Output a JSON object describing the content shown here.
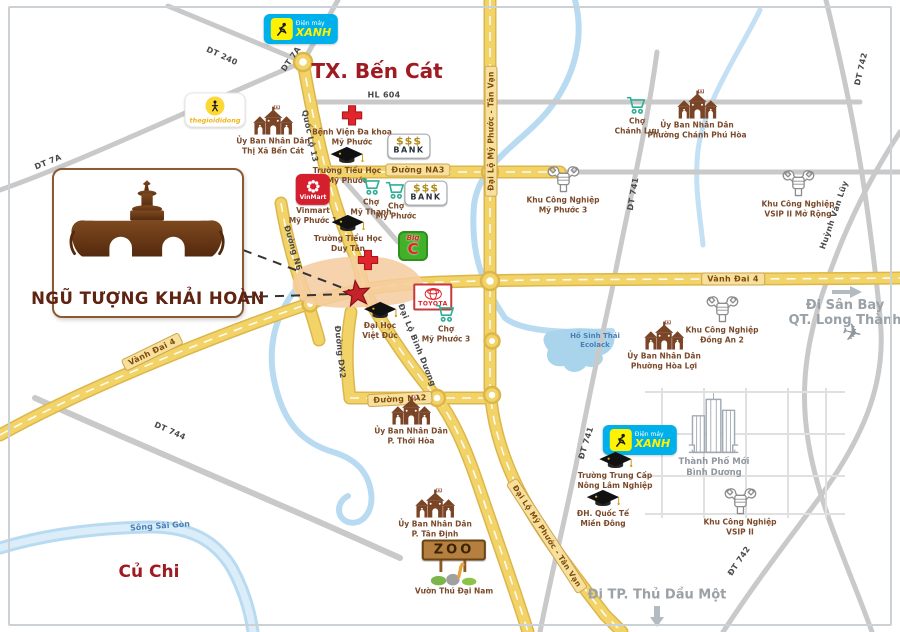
{
  "project": {
    "name": "NGŨ TƯỢNG KHẢI HOÀN"
  },
  "areas": {
    "tx_ben_cat": "TX. Bến Cát",
    "cu_chi": "Củ Chi",
    "song_sai_gon": "Sông Sài Gòn",
    "lake_line1": "Hồ Sinh Thái",
    "lake_line2": "Ecolack"
  },
  "directions": {
    "airport_line1": "Đi Sân Bay",
    "airport_line2": "QT. Long Thành",
    "thu_dau_mot": "Đi TP. Thủ Dầu Một"
  },
  "colors": {
    "road_yellow": "#f2d368",
    "road_gray": "#c9c9c9",
    "river_blue": "#b8dbf2",
    "accent_red": "#9e1b22",
    "star_red": "#c4232c",
    "label_brown": "#7a4a2b"
  },
  "roads": [
    {
      "id": "hl-604",
      "text": "HL 604",
      "style": "plain"
    },
    {
      "id": "dt-240",
      "text": "DT 240",
      "style": "plain"
    },
    {
      "id": "dt-7a-n",
      "text": "DT 7A",
      "style": "plain"
    },
    {
      "id": "dt-7a-w",
      "text": "DT 7A",
      "style": "plain"
    },
    {
      "id": "quoc-lo-13",
      "text": "Quốc Lộ 13",
      "style": "plain"
    },
    {
      "id": "duong-n6",
      "text": "Đường N6",
      "style": "plain"
    },
    {
      "id": "duong-dx2",
      "text": "Đường DX2",
      "style": "plain"
    },
    {
      "id": "dai-lo-binh-duong",
      "text": "Đại Lộ Bình Dương",
      "style": "plain"
    },
    {
      "id": "dt-741-n",
      "text": "DT 741",
      "style": "plain"
    },
    {
      "id": "dt-741-s",
      "text": "ĐT 741",
      "style": "plain"
    },
    {
      "id": "dt-742-n",
      "text": "DT 742",
      "style": "plain"
    },
    {
      "id": "dt-742-s",
      "text": "ĐT 742",
      "style": "plain"
    },
    {
      "id": "huynh-van-luy",
      "text": "Huỳnh Văn Lũy",
      "style": "plain"
    },
    {
      "id": "dt-744",
      "text": "DT 744",
      "style": "plain"
    },
    {
      "id": "vanh-dai-4-w",
      "text": "Vành Đai 4",
      "style": "pill"
    },
    {
      "id": "vanh-dai-4-e",
      "text": "Vành Đai 4",
      "style": "pill"
    },
    {
      "id": "duong-na3",
      "text": "Đường NA3",
      "style": "pill"
    },
    {
      "id": "duong-na2",
      "text": "Đường NA2",
      "style": "pill"
    },
    {
      "id": "dlmptv-n",
      "text": "Đại Lộ Mỹ Phước - Tân Vạn",
      "style": "pill"
    },
    {
      "id": "dlmptv-s",
      "text": "Đại Lộ Mỹ Phước - Tân Vạn",
      "style": "pill"
    }
  ],
  "pois": [
    {
      "id": "dmx-top",
      "icon": "dienmayxanh-logo",
      "brand": {
        "line1": "Điện máy",
        "line2": "XANH"
      }
    },
    {
      "id": "tgdd",
      "icon": "thegioididong-logo",
      "brand": {
        "word": "thegioididong"
      }
    },
    {
      "id": "ubnd-ben-cat",
      "icon": "ubnd-building-icon",
      "lines": [
        "Ủy Ban Nhân Dân",
        "Thị Xã Bến Cát"
      ]
    },
    {
      "id": "benh-vien-my-phuoc",
      "icon": "medical-cross-icon",
      "lines": [
        "Bệnh Viện Đa khoa",
        "Mỹ Phước"
      ]
    },
    {
      "id": "bank-1",
      "icon": "bank-sign",
      "sign": {
        "dollars": "$$$",
        "word": "BANK"
      }
    },
    {
      "id": "truong-th-my-phuoc",
      "icon": "graduation-cap-icon",
      "lines": [
        "Trường Tiểu Học",
        "Mỹ Phước"
      ]
    },
    {
      "id": "cho-chanh-luu",
      "icon": "market-cart-icon",
      "lines": [
        "Chợ",
        "Chánh Lưu"
      ]
    },
    {
      "id": "ubnd-chanh-phu-hoa",
      "icon": "ubnd-building-icon",
      "lines": [
        "Ủy Ban Nhân Dân",
        "Phường Chánh Phú Hòa"
      ]
    },
    {
      "id": "kcn-my-phuoc-3",
      "icon": "industry-icon",
      "lines": [
        "Khu Công Nghiệp",
        "Mỹ Phước 3"
      ]
    },
    {
      "id": "kcn-vsip-2-mo-rong",
      "icon": "industry-icon",
      "lines": [
        "Khu Công Nghiệp",
        "VSIP II Mở Rộng"
      ]
    },
    {
      "id": "bank-2",
      "icon": "bank-sign",
      "sign": {
        "dollars": "$$$",
        "word": "BANK"
      }
    },
    {
      "id": "vinmart",
      "icon": "vinmart-logo",
      "brand": {
        "word": "VinMart"
      },
      "lines": [
        "Vinmart",
        "Mỹ Phước 1"
      ]
    },
    {
      "id": "cho-my-thanh",
      "icon": "market-cart-icon",
      "lines": [
        "Chợ",
        "Mỹ Thạnh"
      ]
    },
    {
      "id": "cho-my-phuoc",
      "icon": "market-cart-icon",
      "lines": [
        "Chợ",
        "Mỹ Phước"
      ]
    },
    {
      "id": "truong-th-duy-tan",
      "icon": "graduation-cap-icon",
      "lines": [
        "Trường Tiểu Học",
        "Duy Tân"
      ]
    },
    {
      "id": "medical-cross-2",
      "icon": "medical-cross-icon",
      "lines": []
    },
    {
      "id": "big-c",
      "icon": "bigc-logo",
      "brand": {
        "small": "Big",
        "big": "C"
      }
    },
    {
      "id": "toyota",
      "icon": "toyota-sign",
      "brand": {
        "word": "TOYOTA"
      }
    },
    {
      "id": "cho-my-phuoc-3",
      "icon": "market-cart-icon",
      "lines": [
        "Chợ",
        "Mỹ Phước 3"
      ]
    },
    {
      "id": "dh-viet-duc",
      "icon": "graduation-cap-icon",
      "lines": [
        "Đại Học",
        "Việt Đức"
      ]
    },
    {
      "id": "ubnd-hoa-loi",
      "icon": "ubnd-building-icon",
      "lines": [
        "Ủy Ban Nhân Dân",
        "Phường Hòa Lợi"
      ]
    },
    {
      "id": "kcn-dong-an-2",
      "icon": "industry-icon",
      "lines": [
        "Khu Công Nghiệp",
        "Đồng An 2"
      ]
    },
    {
      "id": "ubnd-thoi-hoa",
      "icon": "ubnd-building-icon",
      "lines": [
        "Ủy Ban Nhân Dân",
        "P. Thới Hòa"
      ]
    },
    {
      "id": "dmx-2",
      "icon": "dienmayxanh-logo",
      "brand": {
        "line1": "Điện máy",
        "line2": "XANH"
      }
    },
    {
      "id": "thanh-pho-moi",
      "icon": "city-skyline-icon",
      "lines": [
        "Thành Phố Mới",
        "Bình Dương"
      ]
    },
    {
      "id": "truong-trung-cap",
      "icon": "graduation-cap-icon",
      "lines": [
        "Trường Trung Cấp",
        "Nông Lâm Nghiệp"
      ]
    },
    {
      "id": "dh-quoc-te-mien-dong",
      "icon": "graduation-cap-icon",
      "lines": [
        "ĐH. Quốc Tế",
        "Miền Đông"
      ]
    },
    {
      "id": "kcn-vsip-2",
      "icon": "industry-icon",
      "lines": [
        "Khu Công Nghiệp",
        "VSIP II"
      ]
    },
    {
      "id": "ubnd-tan-dinh",
      "icon": "ubnd-building-icon",
      "lines": [
        "Ủy Ban Nhân Dân",
        "P. Tân Định"
      ]
    },
    {
      "id": "zoo",
      "icon": "zoo-sign",
      "brand": {
        "word": "ZOO"
      },
      "lines": [
        "Vườn Thú Đại Nam"
      ]
    }
  ]
}
